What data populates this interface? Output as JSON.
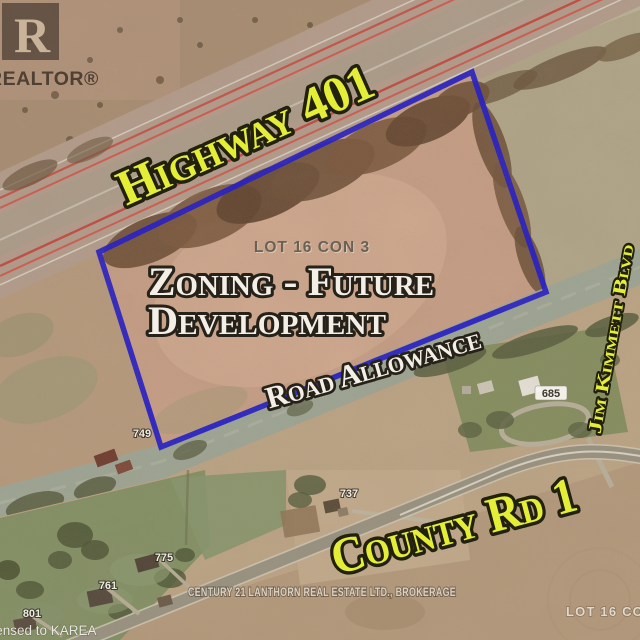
{
  "roads": {
    "highway": "Highway 401",
    "road_allowance": "Road Allowance",
    "jim_kimmett": "Jim Kimmett Blvd",
    "county_rd": "County Rd 1"
  },
  "property": {
    "lot_label": "LOT 16 CON 3",
    "zoning_line1": "Zoning - Future",
    "zoning_line2": "Development",
    "adjacent_lot_label": "LOT 16 CON"
  },
  "house_numbers": {
    "n749": "749",
    "n737": "737",
    "n775": "775",
    "n761": "761",
    "n801": "801",
    "n685": "685"
  },
  "branding": {
    "realtor_r": "R",
    "realtor_wordmark": "REALTOR®",
    "brokerage": "CENTURY 21 LANTHORN REAL ESTATE LTD., BROKERAGE",
    "license": "Licensed to KAREA"
  },
  "colors": {
    "label_yellow": "#e4ee37",
    "label_white": "#f3efe6",
    "outline_black": "#22200f",
    "boundary_blue": "#1e17c9"
  }
}
